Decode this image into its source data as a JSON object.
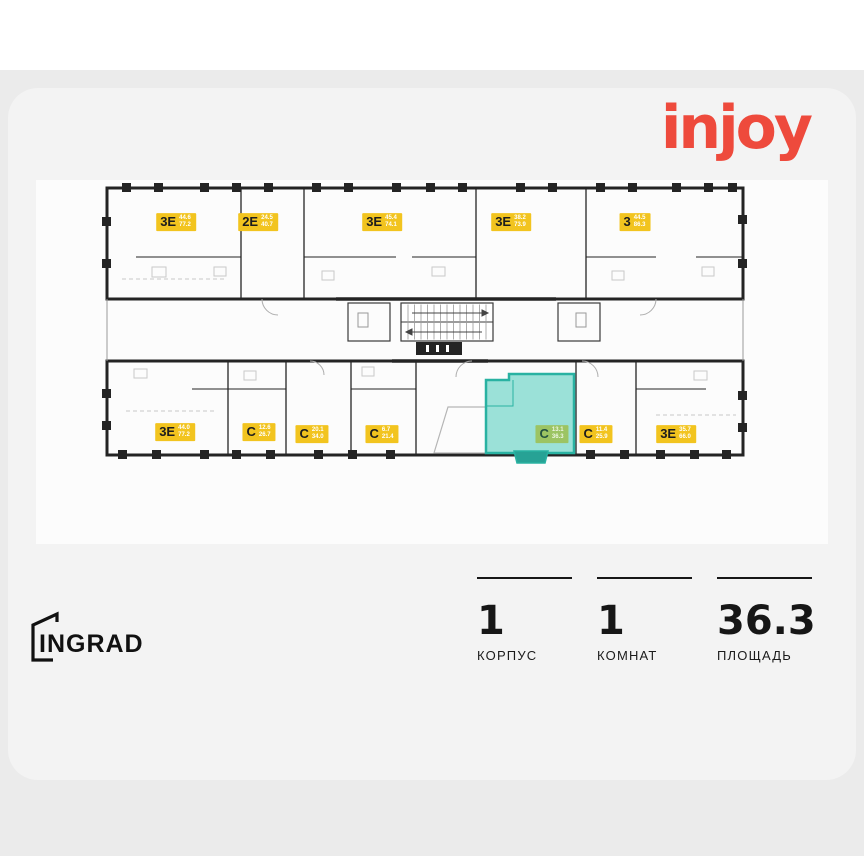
{
  "brand": {
    "name": "injoy",
    "color": "#ee4a3c"
  },
  "developer": {
    "name": "INGRAD"
  },
  "stats": [
    {
      "value": "1",
      "label": "КОРПУС"
    },
    {
      "value": "1",
      "label": "КОМНАТ"
    },
    {
      "value": "36.3",
      "label": "ПЛОЩАДЬ"
    }
  ],
  "floorplan": {
    "colors": {
      "wall": "#242424",
      "label_bg": "#f2c41f",
      "label_type_text": "#1d1d1d",
      "label_area_text": "#ffffff",
      "highlight_stroke": "#29b2a2",
      "highlight_fill": "#7fd8cd",
      "highlight_label_bg": "#9cc463",
      "balcony_fill": "#27a295"
    },
    "units_top": [
      {
        "type": "3Е",
        "area_living": "44.6",
        "area_total": "77.2",
        "x": 80,
        "y": 47
      },
      {
        "type": "2Е",
        "area_living": "24.5",
        "area_total": "40.7",
        "x": 162,
        "y": 47
      },
      {
        "type": "3Е",
        "area_living": "45.4",
        "area_total": "74.1",
        "x": 286,
        "y": 47
      },
      {
        "type": "3Е",
        "area_living": "38.2",
        "area_total": "73.9",
        "x": 415,
        "y": 47
      },
      {
        "type": "3",
        "area_living": "44.5",
        "area_total": "86.3",
        "x": 539,
        "y": 47
      }
    ],
    "units_bottom": [
      {
        "type": "3Е",
        "area_living": "44.0",
        "area_total": "77.2",
        "x": 79,
        "y": 257
      },
      {
        "type": "С",
        "area_living": "12.6",
        "area_total": "26.7",
        "x": 163,
        "y": 257
      },
      {
        "type": "С",
        "area_living": "20.1",
        "area_total": "34.0",
        "x": 216,
        "y": 259
      },
      {
        "type": "С",
        "area_living": "6.7",
        "area_total": "21.4",
        "x": 286,
        "y": 259
      },
      {
        "type": "С",
        "area_living": "11.4",
        "area_total": "25.9",
        "x": 500,
        "y": 259
      },
      {
        "type": "3Е",
        "area_living": "35.7",
        "area_total": "66.0",
        "x": 580,
        "y": 259
      }
    ],
    "highlighted_unit": {
      "type": "С",
      "area_living": "13.1",
      "area_total": "36.3",
      "x": 456,
      "y": 259
    },
    "windows_top": [
      26,
      58,
      104,
      136,
      168,
      216,
      248,
      296,
      330,
      362,
      420,
      452,
      500,
      532,
      576,
      608,
      632
    ],
    "windows_bottom": [
      22,
      56,
      104,
      136,
      170,
      218,
      252,
      290,
      490,
      524,
      560,
      594,
      626
    ]
  }
}
